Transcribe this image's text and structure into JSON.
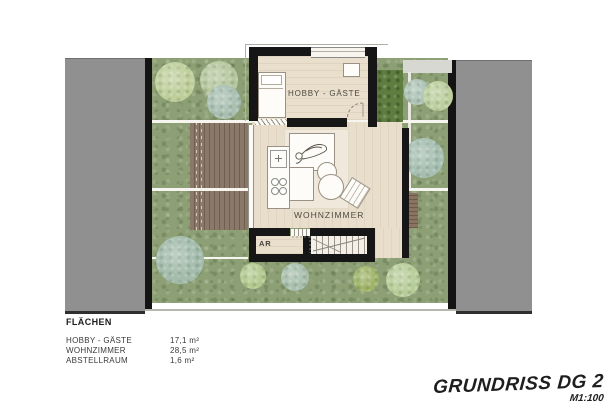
{
  "plan": {
    "rooms": {
      "hobby": {
        "label": "HOBBY - GÄSTE"
      },
      "living": {
        "label": "WOHNZIMMER"
      },
      "storage": {
        "label": "AR"
      }
    }
  },
  "legend": {
    "title": "FLÄCHEN",
    "rows": [
      {
        "label": "HOBBY - GÄSTE",
        "value": "17,1 m²"
      },
      {
        "label": "WOHNZIMMER",
        "value": "28,5 m²"
      },
      {
        "label": "ABSTELLRAUM",
        "value": "1,6 m²"
      }
    ]
  },
  "title_block": {
    "title": "GRUNDRISS DG 2",
    "scale": "M1:100"
  },
  "colors": {
    "wall": "#161616",
    "garden": "#8d9f74",
    "gray_band": "#909090",
    "deck": "#86746a",
    "hedge": "#5f7d40",
    "floor": "#e9dfcc",
    "paper": "#ffffff"
  }
}
